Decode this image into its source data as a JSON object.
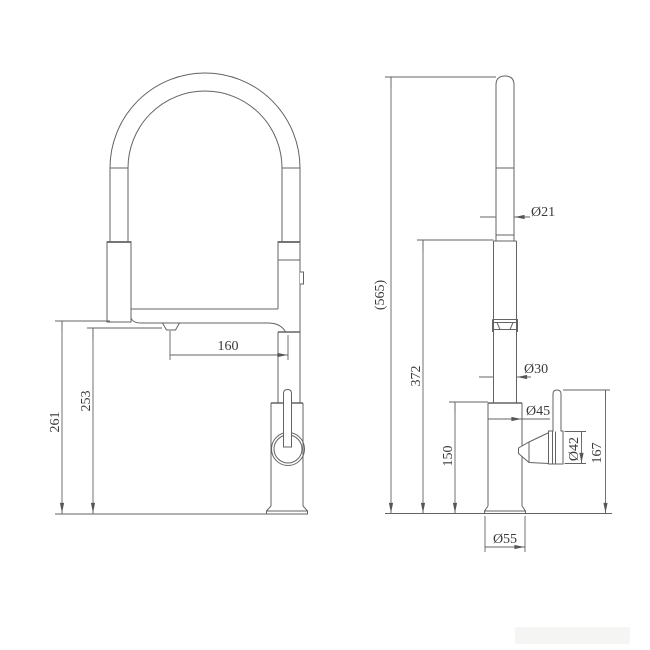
{
  "drawing": {
    "bg_color": "#ffffff",
    "line_color": "#636363",
    "text_color": "#3a3a3a",
    "front_view": {
      "spout_reach_mm": "160",
      "overall_height_mm": "261",
      "spout_outlet_height_mm": "253"
    },
    "side_view": {
      "reference_total_height_mm": "(565)",
      "hose_top_height_mm": "372",
      "body_height_mm": "150",
      "handle_top_height_mm": "167",
      "wand_diameter": "Ø21",
      "pipe_diameter": "Ø30",
      "body_diameter": "Ø45",
      "handle_diameter": "Ø42",
      "base_diameter": "Ø55"
    }
  }
}
